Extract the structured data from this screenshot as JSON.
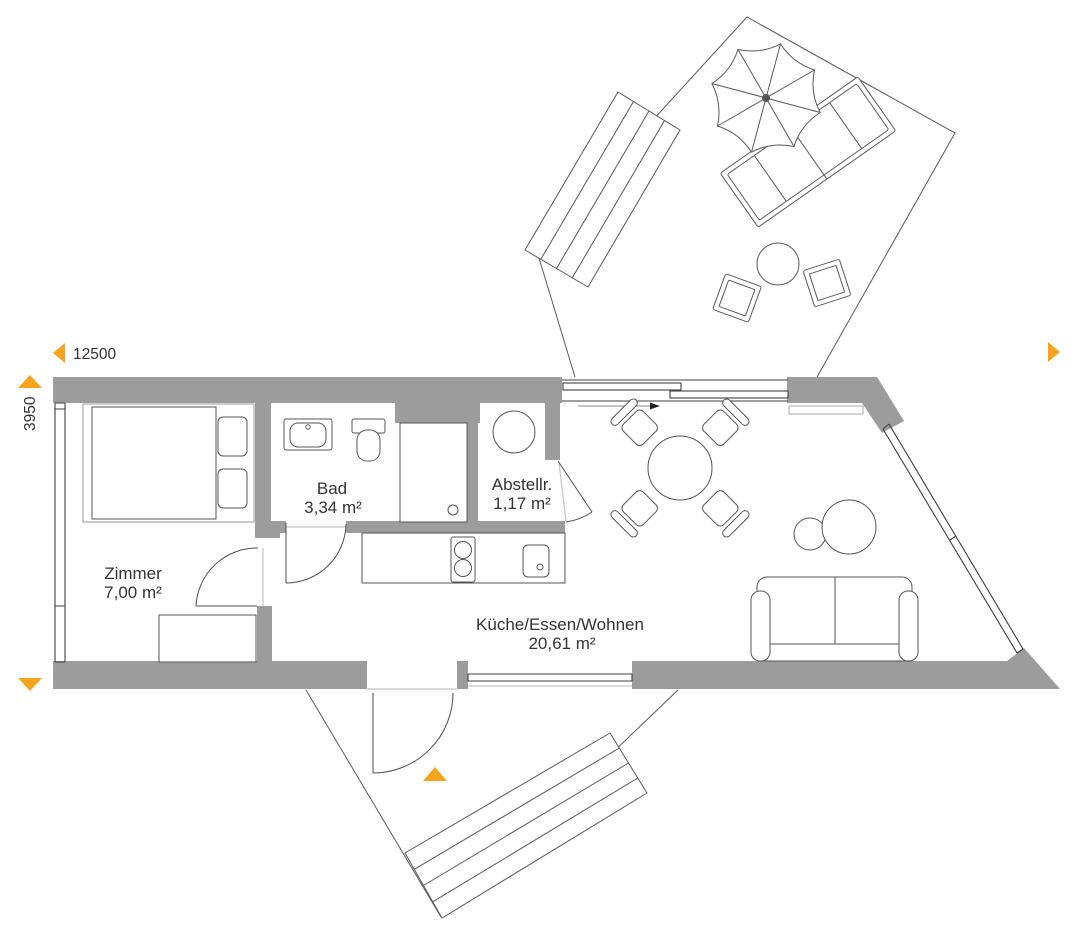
{
  "dimensions": {
    "width_label": "12500",
    "height_label": "3950"
  },
  "rooms": {
    "zimmer": {
      "name": "Zimmer",
      "area": "7,00 m²"
    },
    "bad": {
      "name": "Bad",
      "area": "3,34 m²"
    },
    "abstellraum": {
      "name": "Abstellr.",
      "area": "1,17 m²"
    },
    "kueche": {
      "name": "Küche/Essen/Wohnen",
      "area": "20,61 m²"
    }
  },
  "furniture": [
    "double-bed",
    "dresser",
    "washbasin",
    "toilet",
    "shower",
    "washing-machine",
    "kitchen-counter",
    "cooktop",
    "kitchen-sink",
    "dining-table",
    "dining-chair",
    "coffee-table",
    "sofa",
    "parasol",
    "sun-lounger",
    "terrace-table",
    "terrace-stool",
    "terrace-steps",
    "entrance-steps"
  ],
  "colors": {
    "wall": "#9c9c9c",
    "accent": "#F6A41E",
    "line": "#4a4a4a",
    "text": "#333333"
  }
}
